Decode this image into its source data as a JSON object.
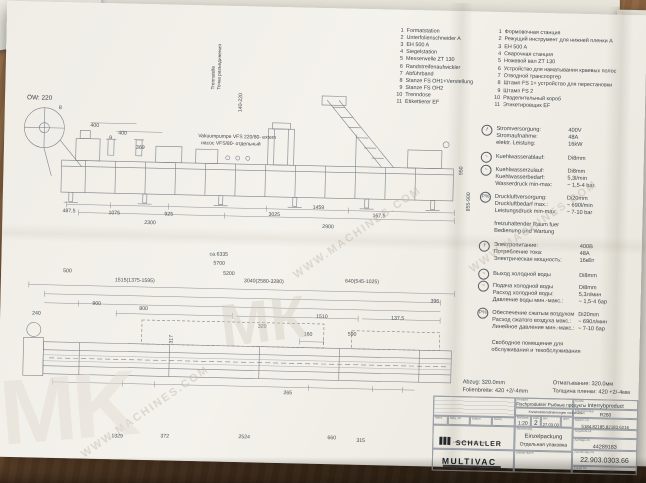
{
  "watermark": {
    "site": "WWW.MACHINES.COM",
    "monogram": "MK",
    "monogram2": "МК"
  },
  "legend": {
    "items": [
      {
        "n": "1",
        "de": "Formatstation",
        "ru": "Формовочная станция"
      },
      {
        "n": "2",
        "de": "Unterfolienschneider A",
        "ru": "Режущий инструмент для нижней пленки А"
      },
      {
        "n": "3",
        "de": "EH 500 A",
        "ru": "EH 500 A"
      },
      {
        "n": "4",
        "de": "Siegelstation",
        "ru": "Сварочная станция"
      },
      {
        "n": "5",
        "de": "Messerwelle ZT 130",
        "ru": "Ножевой вал ZT 130"
      },
      {
        "n": "6",
        "de": "Randstreifenaufwickler",
        "ru": "Устройство для наматывания краевых полос"
      },
      {
        "n": "7",
        "de": "Abführband",
        "ru": "Отводной транспортер"
      },
      {
        "n": "8",
        "de": "Stanze FS OH1+Verstellung",
        "ru": "Штамп FS 1+ устройство для перестановки"
      },
      {
        "n": "9",
        "de": "Stanze FS OH2",
        "ru": "Штамп FS 2"
      },
      {
        "n": "10",
        "de": "Trenndose",
        "ru": "Разделительный короб"
      },
      {
        "n": "11",
        "de": "Etikettierer EF",
        "ru": "Этикетировщик EF"
      }
    ]
  },
  "icons": {
    "power": "f",
    "water": "~",
    "air": "P%"
  },
  "specs_de": {
    "rows": [
      {
        "l": "Stromversorgung:",
        "v": "400V"
      },
      {
        "l": "Stromaufnahme:",
        "v": "48A"
      },
      {
        "l": "elektr. Leistung:",
        "v": "16kW"
      },
      {
        "l": "Kuehlwasserablauf:",
        "v": "Di8mm"
      },
      {
        "l": "Kuehlwasserzulauf:",
        "v": "Di8mm"
      },
      {
        "l": "Kuehlwasserbedarf:",
        "v": "5,3l/min"
      },
      {
        "l": "Wasserdruck min-max:",
        "v": "~ 1,5-4 bar"
      },
      {
        "l": "Druckluftversorgung:",
        "v": "Di20mm"
      },
      {
        "l": "Druckluftbedarf max.:",
        "v": "~ 690l/min"
      },
      {
        "l": "Leistungsdruck min-max:",
        "v": "~ 7-10 bar"
      }
    ],
    "note1": "freizuhaltender Raum fuer",
    "note2": "Bedienung und Wartung"
  },
  "specs_ru": {
    "rows": [
      {
        "l": "Электропитание:",
        "v": "400В"
      },
      {
        "l": "Потребление тока:",
        "v": "48А"
      },
      {
        "l": "Электрическая мощность:",
        "v": "16кВт"
      },
      {
        "l": "Выход холодной воды",
        "v": "Di8mm"
      },
      {
        "l": "Подача холодной воды",
        "v": "Di8mm"
      },
      {
        "l": "Расход холодной воды:",
        "v": "5,3л/мин"
      },
      {
        "l": "Давление воды мин.-макс.:",
        "v": "~ 1,5-4 бар"
      },
      {
        "l": "Обеспечение сжатым воздухом",
        "v": "Di20mm"
      },
      {
        "l": "Расход сжатого воздуха макс.:",
        "v": "~ 690л/мин"
      },
      {
        "l": "Линейное давление мин.-макс.:",
        "v": "~ 7-10 бар"
      }
    ],
    "note1": "Свободное помещение для",
    "note2": "обслуживания и техобслуживания"
  },
  "side_view": {
    "ow": "ÖW: 220",
    "reel": "8",
    "d400a": "400",
    "d9": "9",
    "d400b": "400",
    "d369": "369",
    "pump_de": "Vakuumpumpe VFS 220/80- extern",
    "pump_ru": "насос VFS/80- отдельный",
    "trenn_de": "Trennstelle",
    "trenn_ru": "Точка разъединения",
    "d140": "140-220",
    "d950": "950",
    "d855": "855-900",
    "c1": "487,5",
    "c2": "1075",
    "c3": "925",
    "c4": "3025",
    "c5": "1459",
    "c6": "167,5",
    "c7": "2300",
    "c8": "2900"
  },
  "top_view": {
    "d6335": "ca.6335",
    "d5700": "5700",
    "d500": "500",
    "d5200": "5200",
    "d1515": "1515(1375-1595)",
    "d3040": "3040(2580-3280)",
    "d640": "640(545-1025)",
    "d396": "396",
    "d240": "240",
    "d900": "900",
    "d800": "800",
    "d1510": "1510",
    "d137": "137,5",
    "d320": "320",
    "d160": "160",
    "d590": "590",
    "d317": "317",
    "d265": "265",
    "b1": "1329",
    "b2": "372",
    "b3": "2524",
    "b4": "660",
    "b5": "315"
  },
  "film_note": {
    "de1": "Abzug: 320.0mm",
    "ru1": "Отматывание: 320.0мм",
    "de2": "Folienbreite: 420 +2/-4mm",
    "ru2": "Толщина пленки: 420 +2/-4мм"
  },
  "titleblock": {
    "produkt_label": "Produkt",
    "product": "Fischprodukte/ Рыбные продукты",
    "note": "Konstruktionsänderungen vorbehalten",
    "kunde_label": "Kunde",
    "kunde": "Interrybproduct",
    "typ_label": "Maschinentyp",
    "typ": "R260",
    "index": "Index",
    "bldg": "Bldg.-Nr",
    "datum": "Datum",
    "name": "Name",
    "massstab_label": "Maßstab",
    "massstab": "1:20",
    "blatt_label": "Blatt",
    "blatt": "2",
    "gez": "gez.",
    "gez_date": "27.03.03",
    "gepr": "gepr.",
    "manr_label": "Masch.-Nr.",
    "manr": "5184.82185.82183.6216",
    "angebot_label": "Angebots-Nr.",
    "auftrag_label": "Auftrags-Nr.",
    "auftrag": "44289183",
    "zeichnung_label": "Zeichnungs-Nr.",
    "zeichnung": "22.903.0303.66",
    "benennung_label": "Benennung",
    "benennung_de": "Einzelpackung",
    "benennung_ru": "Отдельная упаковка",
    "ersetzt": "ersetzt durch",
    "ersatz": "Ersatz für",
    "schaller": "SCHALLER",
    "schaller_sub": "LEBENSMITTELTECHNIK",
    "multivac": "MULTIVAC"
  }
}
